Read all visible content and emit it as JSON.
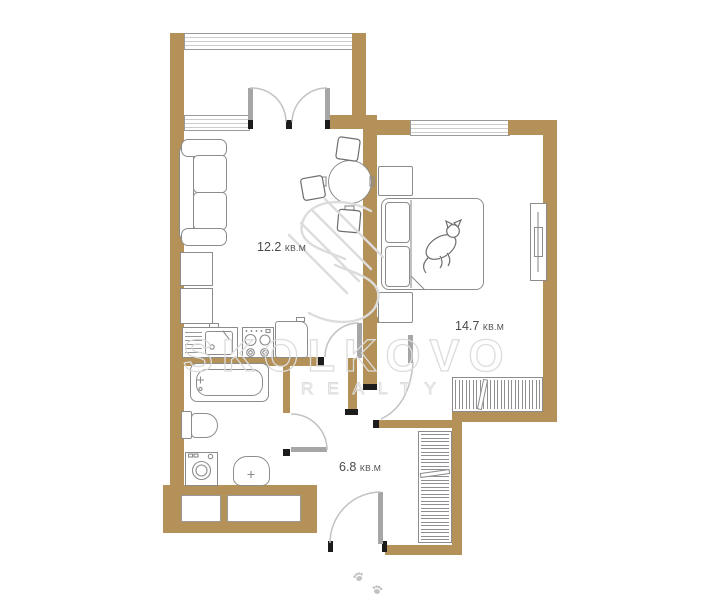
{
  "plan": {
    "rooms": [
      {
        "name": "living-kitchen",
        "area": "12.2",
        "unit": "КВ.М"
      },
      {
        "name": "bedroom",
        "area": "14.7",
        "unit": "КВ.М"
      },
      {
        "name": "hallway",
        "area": "6.8",
        "unit": "КВ.М"
      }
    ],
    "watermark": {
      "brand": "SKOLKOVO",
      "subtitle": "REALTY"
    }
  },
  "colors": {
    "wall": "#b39158",
    "furniture_line": "#8c8c8c",
    "door_leaf": "#a6a6a6",
    "swing_arc": "#c2c2c2",
    "cap": "#1c1c1c",
    "label_text": "#4a4a4a",
    "watermark": "#dcdcdc"
  }
}
